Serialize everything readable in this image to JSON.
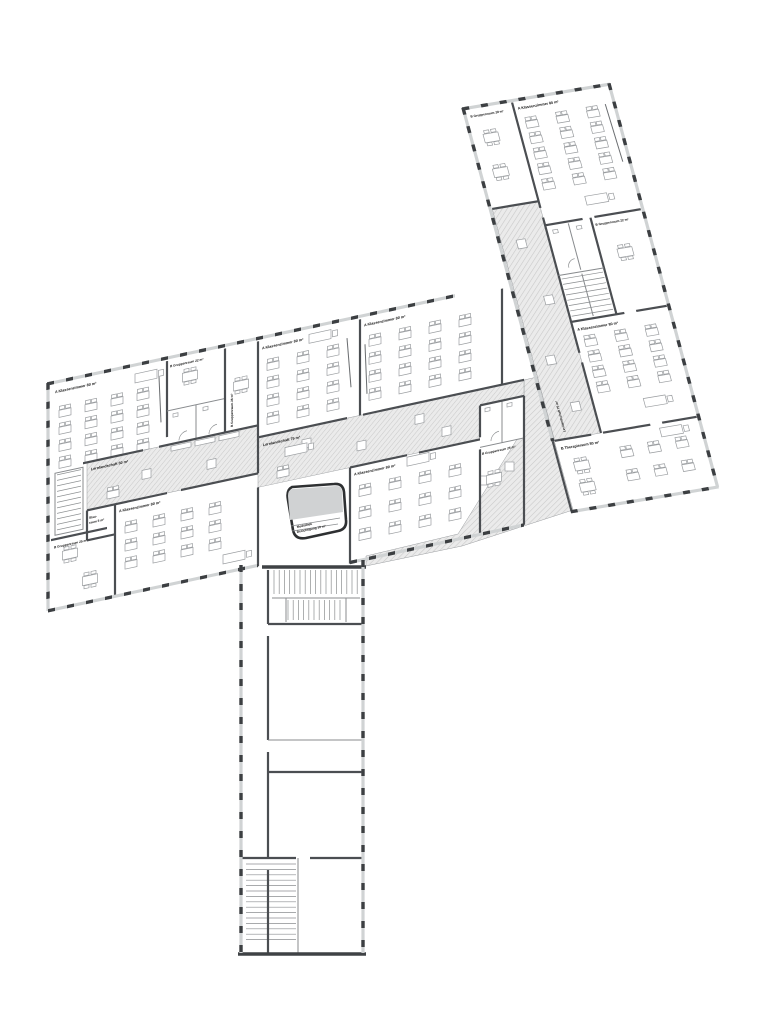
{
  "plan": {
    "rooms": {
      "left_classroom_1": "A Klassenzimmer 80 m²",
      "left_group_22": "B Gruppenraum 22 m²",
      "left_group_26": "B Gruppenraum 26 m²",
      "left_learn_landscape": "Lernlandschaft 50 m²",
      "left_storage_line1": "Stau-",
      "left_storage_line2": "raum 5 m²",
      "left_classroom_2": "A Klassenzimmer 80 m²",
      "left_group_25": "B Gruppenraum 25 m²",
      "center_classroom_1": "A Klassenzimmer 80 m²",
      "center_classroom_2": "A Klassenzimmer 80 m²",
      "center_learn_landscape": "Lernlandschaft 75 m²",
      "center_classroom_3": "A Klassenzimmer 80 m²",
      "center_group_25": "B Gruppenraum 25 m²",
      "mediathek_line1": "Mediathek",
      "mediathek_line2": "Besichtigung 10 m²",
      "right_group_28": "B Gruppenraum 28 m²",
      "right_classroom_1": "A Klassenzimmer 80 m²",
      "right_group_22": "B Gruppenraum 22 m²",
      "right_classroom_2": "A Klassenzimmer 80 m²",
      "right_learn_landscape": "Lernlandschaft 75 m²",
      "right_therapy": "B Therapieraum 80 m²"
    },
    "colors": {
      "wall": "#3f4245",
      "wall_medium": "#55585b",
      "hatch_bg": "#ebebeb",
      "hatch_line": "#c8c8c8",
      "window_band": "#d0d3d4",
      "mediathek_fill": "#d0d2d3"
    }
  }
}
